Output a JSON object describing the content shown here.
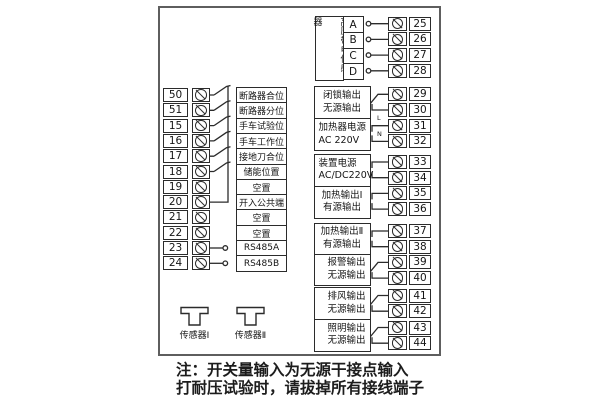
{
  "note": {
    "line1": "注：开关量输入为无源干接点输入",
    "line2": "打耐压试验时，请拔掉所有接线端子"
  },
  "left_inputs": {
    "rows": [
      {
        "terminal": "50",
        "label": "断路器合位",
        "type": "switch"
      },
      {
        "terminal": "51",
        "label": "断路器分位",
        "type": "switch"
      },
      {
        "terminal": "15",
        "label": "手车试验位",
        "type": "switch"
      },
      {
        "terminal": "16",
        "label": "手车工作位",
        "type": "switch"
      },
      {
        "terminal": "17",
        "label": "接地刀合位",
        "type": "switch"
      },
      {
        "terminal": "18",
        "label": "储能位置",
        "type": "switch"
      },
      {
        "terminal": "19",
        "label": "空置",
        "type": "none"
      },
      {
        "terminal": "20",
        "label": "开入公共端",
        "type": "common"
      },
      {
        "terminal": "21",
        "label": "空置",
        "type": "none"
      },
      {
        "terminal": "22",
        "label": "空置",
        "type": "none"
      },
      {
        "terminal": "23",
        "label": "RS485A",
        "type": "comm-line"
      },
      {
        "terminal": "24",
        "label": "RS485B",
        "type": "comm-line"
      }
    ]
  },
  "hv_sensor_block": {
    "label": "高压带电传感器",
    "channels": [
      {
        "name": "A",
        "terminal": "25"
      },
      {
        "name": "B",
        "terminal": "26"
      },
      {
        "name": "C",
        "terminal": "27"
      },
      {
        "name": "D",
        "terminal": "28"
      }
    ]
  },
  "output_blocks": [
    {
      "line1": "闭锁输出",
      "line2": "无源输出",
      "terminals": [
        "29",
        "30"
      ],
      "symbol": "contact"
    },
    {
      "line1": "加热器电源",
      "line2": "AC 220V",
      "terminals": [
        "31",
        "32"
      ],
      "symbol": "power",
      "wire_labels": [
        "L",
        "N"
      ]
    },
    {
      "line1": "装置电源",
      "line2": "AC/DC220V",
      "terminals": [
        "33",
        "34"
      ],
      "symbol": "power"
    },
    {
      "line1": "加热输出Ⅰ",
      "line2": "有源输出",
      "terminals": [
        "35",
        "36"
      ],
      "symbol": "power"
    },
    {
      "line1": "加热输出Ⅱ",
      "line2": "有源输出",
      "terminals": [
        "37",
        "38"
      ],
      "symbol": "power"
    },
    {
      "line1": "报警输出",
      "line2": "无源输出",
      "terminals": [
        "39",
        "40"
      ],
      "symbol": "contact"
    },
    {
      "line1": "排风输出",
      "line2": "无源输出",
      "terminals": [
        "41",
        "42"
      ],
      "symbol": "contact"
    },
    {
      "line1": "照明输出",
      "line2": "无源输出",
      "terminals": [
        "43",
        "44"
      ],
      "symbol": "contact"
    }
  ],
  "sensors": [
    {
      "label": "传感器Ⅰ"
    },
    {
      "label": "传感器Ⅱ"
    }
  ]
}
